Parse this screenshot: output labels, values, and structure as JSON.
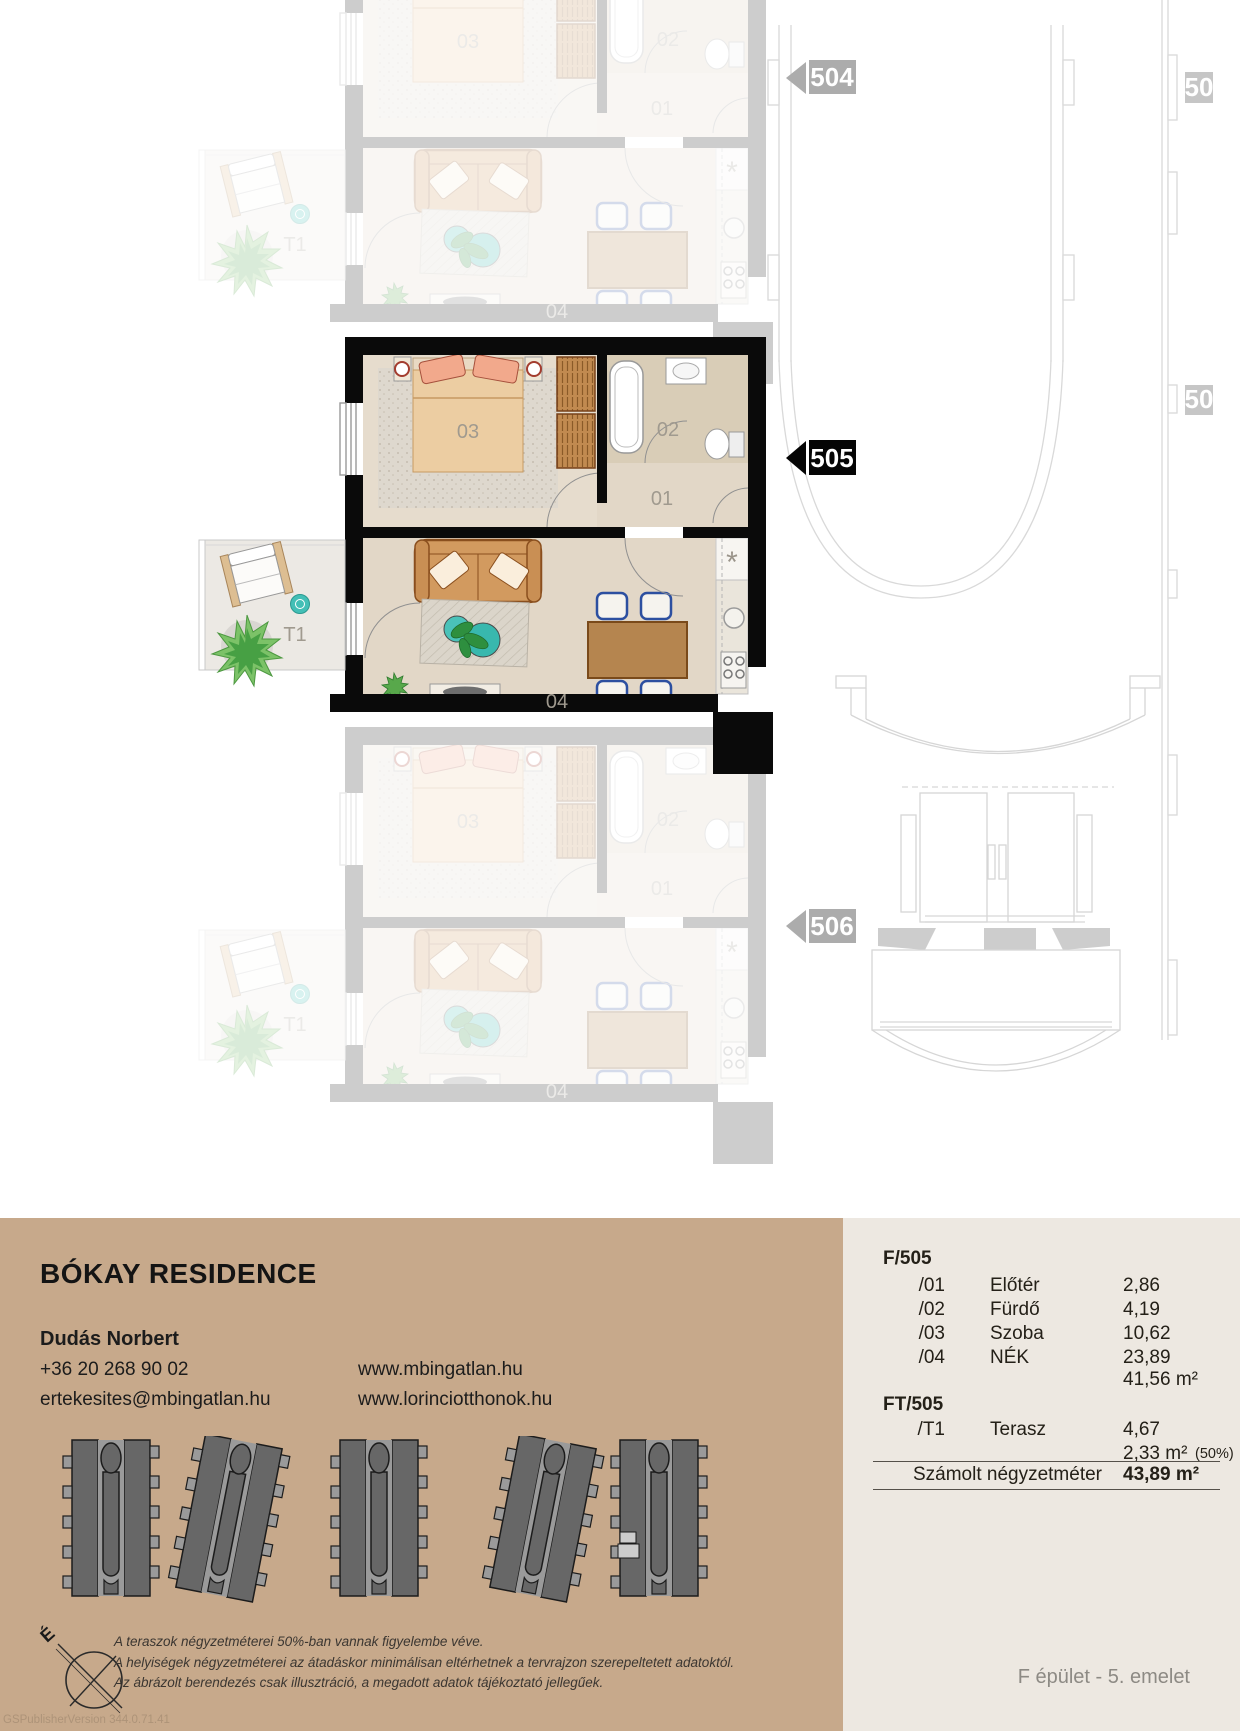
{
  "plan": {
    "markers": {
      "top_left": "504",
      "current": "505",
      "bottom_left": "506",
      "right_top": "50",
      "right_mid": "50"
    },
    "rooms": {
      "hall": "01",
      "bath": "02",
      "bedroom": "03",
      "living": "04",
      "terrace": "T1",
      "kitchen_mark": "*"
    }
  },
  "info": {
    "title": "BÓKAY RESIDENCE",
    "agent": "Dudás Norbert",
    "phone": "+36 20 268 90 02",
    "email": "ertekesites@mbingatlan.hu",
    "web1": "www.mbingatlan.hu",
    "web2": "www.lorinciotthonok.hu",
    "compass_letter": "É",
    "disclaimer": [
      "A teraszok négyzetméterei 50%-ban vannak figyelembe véve.",
      "A helyiségek négyzetméterei az átadáskor minimálisan eltérhetnek a tervrajzon szerepeltetett adatoktól.",
      "Az ábrázolt berendezés csak illusztráció, a megadott adatok tájékoztató jellegűek."
    ],
    "watermark": "GSPublisherVersion 344.0.71.41"
  },
  "area_table": {
    "group1": "F/505",
    "rows": [
      {
        "code": "/01",
        "name": "Előtér",
        "value": "2,86"
      },
      {
        "code": "/02",
        "name": "Fürdő",
        "value": "4,19"
      },
      {
        "code": "/03",
        "name": "Szoba",
        "value": "10,62"
      },
      {
        "code": "/04",
        "name": "NÉK",
        "value": "23,89"
      }
    ],
    "subtotal": "41,56 m²",
    "group2": "FT/505",
    "terrace_row": {
      "code": "/T1",
      "name": "Terasz",
      "value": "4,67"
    },
    "terrace_half": "2,33 m²",
    "terrace_note": "(50%)",
    "total_label": "Számolt négyzetméter",
    "total_value": "43,89 m²",
    "floor_label": "F épület - 5. emelet"
  },
  "colors": {
    "panel_tan": "#C7A98B",
    "panel_light": "#EDE8E1",
    "wall_black": "#0a0a0a",
    "marker_grey": "#ACACAC",
    "accent_teal": "#43BFB6",
    "wood_floor": "#E2D7C7",
    "outline_grey": "#D9D9D9"
  }
}
